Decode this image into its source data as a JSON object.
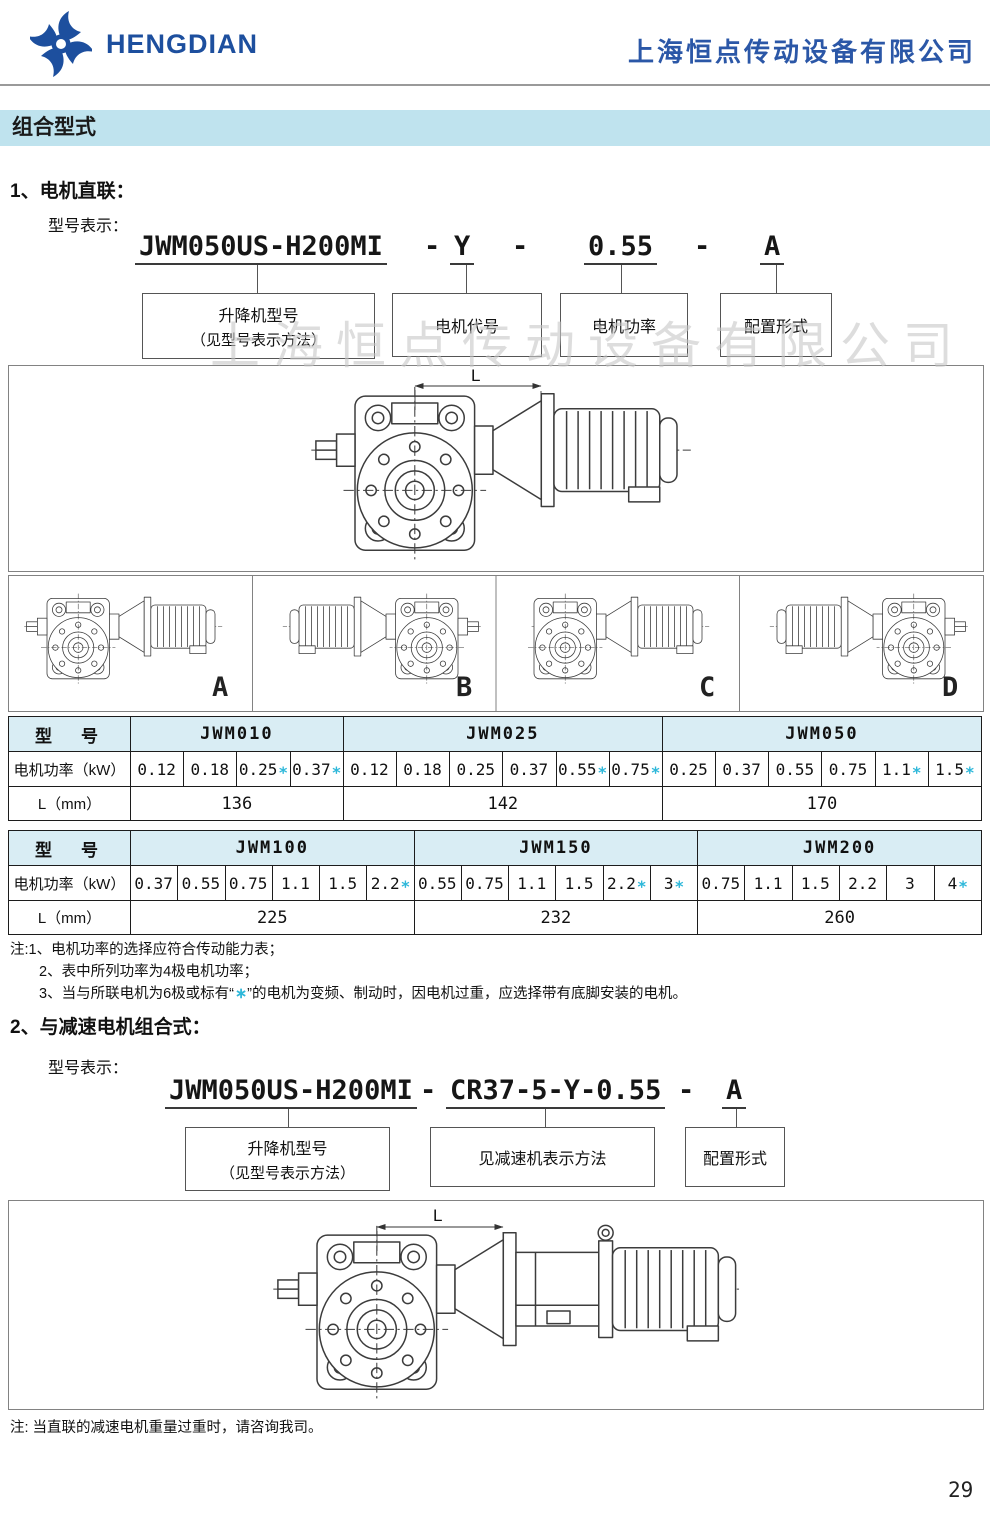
{
  "header": {
    "brand": "HENGDIAN",
    "company": "上海恒点传动设备有限公司"
  },
  "section_title": "组合型式",
  "watermark": "上海恒点传动设备有限公司",
  "s1": {
    "heading": "1、电机直联：",
    "model_label": "型号表示：",
    "code": {
      "base": "JWM050US-H200MI",
      "dash": "-",
      "motor": "Y",
      "power": "0.55",
      "config": "A"
    },
    "callouts": {
      "lifter_line1": "升降机型号",
      "lifter_line2": "（见型号表示方法）",
      "motor": "电机代号",
      "power": "电机功率",
      "config": "配置形式"
    },
    "dim_label": "L",
    "variants": [
      "A",
      "B",
      "C",
      "D"
    ]
  },
  "tables": [
    {
      "col_label": "型　号",
      "power_label": "电机功率（kW）",
      "l_label": "L（mm）",
      "groups": [
        {
          "name": "JWM010",
          "l": "136",
          "powers": [
            [
              "0.12",
              ""
            ],
            [
              "0.18",
              ""
            ],
            [
              "0.25",
              "∗"
            ],
            [
              "0.37",
              "∗"
            ]
          ]
        },
        {
          "name": "JWM025",
          "l": "142",
          "powers": [
            [
              "0.12",
              ""
            ],
            [
              "0.18",
              ""
            ],
            [
              "0.25",
              ""
            ],
            [
              "0.37",
              ""
            ],
            [
              "0.55",
              "∗"
            ],
            [
              "0.75",
              "∗"
            ]
          ]
        },
        {
          "name": "JWM050",
          "l": "170",
          "powers": [
            [
              "0.25",
              ""
            ],
            [
              "0.37",
              ""
            ],
            [
              "0.55",
              ""
            ],
            [
              "0.75",
              ""
            ],
            [
              "1.1",
              "∗"
            ],
            [
              "1.5",
              "∗"
            ]
          ]
        }
      ]
    },
    {
      "col_label": "型　号",
      "power_label": "电机功率（kW）",
      "l_label": "L（mm）",
      "groups": [
        {
          "name": "JWM100",
          "l": "225",
          "powers": [
            [
              "0.37",
              ""
            ],
            [
              "0.55",
              ""
            ],
            [
              "0.75",
              ""
            ],
            [
              "1.1",
              ""
            ],
            [
              "1.5",
              ""
            ],
            [
              "2.2",
              "∗"
            ]
          ]
        },
        {
          "name": "JWM150",
          "l": "232",
          "powers": [
            [
              "0.55",
              ""
            ],
            [
              "0.75",
              ""
            ],
            [
              "1.1",
              ""
            ],
            [
              "1.5",
              ""
            ],
            [
              "2.2",
              "∗"
            ],
            [
              "3",
              "∗"
            ]
          ]
        },
        {
          "name": "JWM200",
          "l": "260",
          "powers": [
            [
              "0.75",
              ""
            ],
            [
              "1.1",
              ""
            ],
            [
              "1.5",
              ""
            ],
            [
              "2.2",
              ""
            ],
            [
              "3",
              ""
            ],
            [
              "4",
              "∗"
            ]
          ]
        }
      ]
    }
  ],
  "notes": {
    "line1": "注:1、电机功率的选择应符合传动能力表；",
    "line2": "2、表中所列功率为4极电机功率；",
    "line3_prefix": "3、当与所联电机为6极或标有“",
    "line3_star": "∗",
    "line3_suffix": "”的电机为变频、制动时，因电机过重，应选择带有底脚安装的电机。"
  },
  "s2": {
    "heading": "2、与减速电机组合式：",
    "model_label": "型号表示：",
    "code": {
      "base": "JWM050US-H200MI",
      "dash": "-",
      "reducer": "CR37-5-Y-0.55",
      "config": "A"
    },
    "callouts": {
      "lifter_line1": "升降机型号",
      "lifter_line2": "（见型号表示方法）",
      "reducer": "见减速机表示方法",
      "config": "配置形式"
    },
    "dim_label": "L",
    "note": "注: 当直联的减速电机重量过重时，请咨询我司。"
  },
  "page_number": "29",
  "colors": {
    "brand_blue": "#1d4f9e",
    "company_blue": "#2b57a7",
    "band_bg": "#bfe3ee",
    "table_header_bg": "#d9edf4",
    "star_cyan": "#2fb8da",
    "drawing_line": "#3c3c3c"
  }
}
